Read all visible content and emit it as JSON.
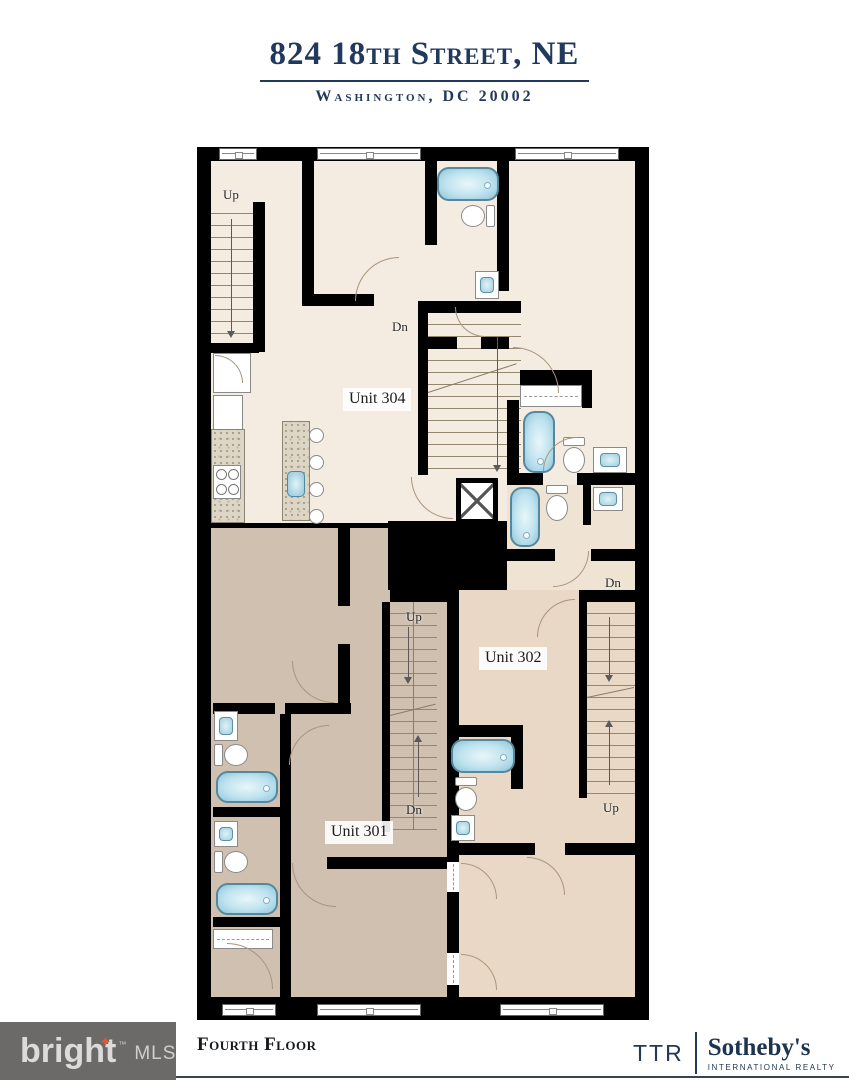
{
  "header": {
    "title": "824 18th Street, NE",
    "subtitle": "Washington, DC 20002"
  },
  "plan": {
    "units": [
      {
        "id": "unit-304",
        "label": "Unit 304"
      },
      {
        "id": "unit-302",
        "label": "Unit 302"
      },
      {
        "id": "unit-301",
        "label": "Unit 301"
      }
    ],
    "stairs": [
      {
        "location": "upper-left",
        "label": "Up"
      },
      {
        "location": "unit-304-center",
        "label": "Dn"
      },
      {
        "location": "unit-301-top",
        "label": "Up"
      },
      {
        "location": "unit-301-bottom",
        "label": "Dn"
      },
      {
        "location": "unit-302-top",
        "label": "Dn"
      },
      {
        "location": "unit-302-bottom",
        "label": "Up"
      }
    ],
    "colors": {
      "wall": "#000000",
      "unit304_floor": "#f4ebe1",
      "hall_floor": "#efe3d3",
      "unit301_floor": "#cfc0b0",
      "unit302_floor": "#e9d8c5",
      "tub_fill": "#bfe3ef",
      "tub_border": "#55889e",
      "title_navy": "#21395c"
    }
  },
  "footer": {
    "floor_label": "Fourth Floor",
    "bright_mls": {
      "name": "bright",
      "trademark": "™",
      "mls": "MLS",
      "star_color": "#e05a2b",
      "box_color": "#6b6a69"
    },
    "ttr_sothebys": {
      "ttr": "TTR",
      "brand": "Sotheby's",
      "tagline": "INTERNATIONAL REALTY"
    }
  }
}
